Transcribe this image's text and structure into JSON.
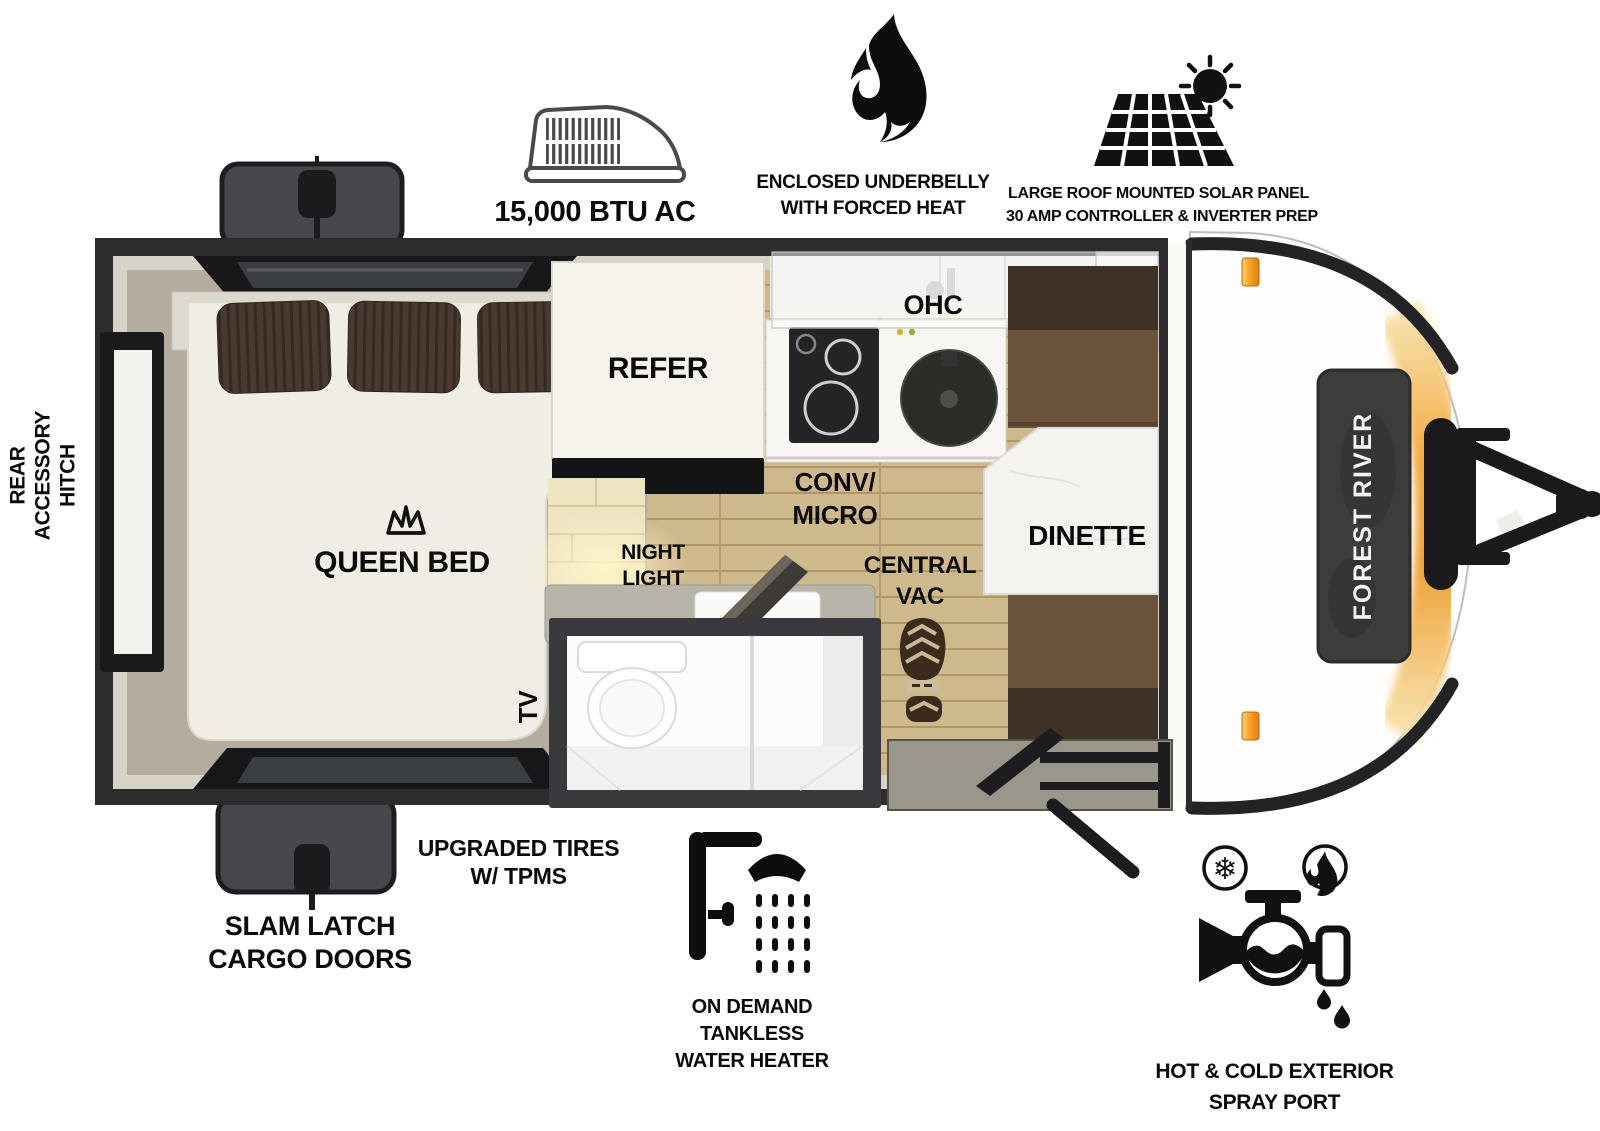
{
  "title": "Forest River travel trailer floorplan",
  "brand": {
    "badge": "FOREST RIVER"
  },
  "icons": {
    "snowflake_glyph": "❄"
  },
  "colors": {
    "wall": "#2c2c2e",
    "wall_face": "#d7d3c8",
    "bedroom_floor": "#b4ad9f",
    "wood_floor": "#ceb98d",
    "wood_seam": "#b09668",
    "mattress": "#efede4",
    "pillow": "#4a3931",
    "bench": "#6b523c",
    "bench_dark": "#3e3126",
    "table": "#f4f3ef",
    "counter": "#b9b4aa",
    "tile_wall": "#efe4c2",
    "accent_amber": "#f3a73c",
    "marker_light": "#f59b20",
    "badge_bg": "#3b3d3d",
    "icon_ink": "#0d0d0d"
  },
  "callouts": {
    "ac": {
      "label": "15,000 BTU AC"
    },
    "underbelly": {
      "line1": "ENCLOSED UNDERBELLY",
      "line2": "WITH FORCED HEAT"
    },
    "solar": {
      "line1": "LARGE ROOF MOUNTED SOLAR PANEL",
      "line2": "30 AMP CONTROLLER & INVERTER PREP"
    },
    "rear_hitch": {
      "line1": "REAR",
      "line2": "ACCESSORY",
      "line3": "HITCH"
    },
    "slam_latch": {
      "line1": "SLAM LATCH",
      "line2": "CARGO DOORS"
    },
    "tires": {
      "line1": "UPGRADED TIRES",
      "line2": "W/ TPMS"
    },
    "water_heater": {
      "line1": "ON DEMAND",
      "line2": "TANKLESS",
      "line3": "WATER HEATER"
    },
    "spray_port": {
      "line1": "HOT & COLD EXTERIOR",
      "line2": "SPRAY PORT"
    }
  },
  "rooms": {
    "queen_bed": "QUEEN BED",
    "tv": "TV",
    "refer": "REFER",
    "ohc": "OHC",
    "conv_micro": {
      "line1": "CONV/",
      "line2": "MICRO"
    },
    "night_light": {
      "line1": "NIGHT",
      "line2": "LIGHT"
    },
    "central_vac": {
      "line1": "CENTRAL",
      "line2": "VAC"
    },
    "dinette": "DINETTE"
  }
}
